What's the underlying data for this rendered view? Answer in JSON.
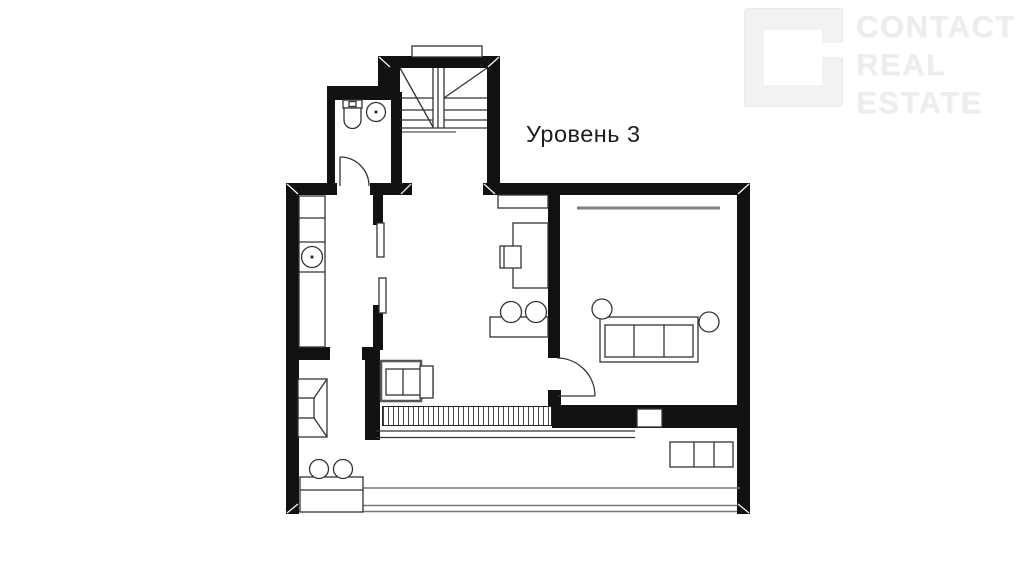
{
  "page": {
    "background_color": "#ffffff"
  },
  "title": {
    "text": "Уровень 3",
    "color": "#1c1c1c"
  },
  "watermark": {
    "line1": "CONTACT",
    "line2": "REAL",
    "line3": "ESTATE",
    "color": "#ededed"
  },
  "plan": {
    "wall_color": "#111111",
    "furniture_line_color": "#333333",
    "curtain_color": "#808080",
    "symbols": [
      "staircase",
      "stair-window-niche",
      "toilet",
      "wash-basin",
      "bathroom-door",
      "kitchen-counter",
      "kitchen-sink",
      "sliding-panels",
      "shelf",
      "desk",
      "desk-chair",
      "bar-table",
      "bar-stools",
      "curtain-line",
      "sofa",
      "side-tables",
      "living-room-door",
      "fireplace",
      "armchair",
      "lower-stairs-hatch",
      "ventilation-niche",
      "terrace-table",
      "terrace-stools",
      "cabinet",
      "terrace-glazing"
    ]
  }
}
